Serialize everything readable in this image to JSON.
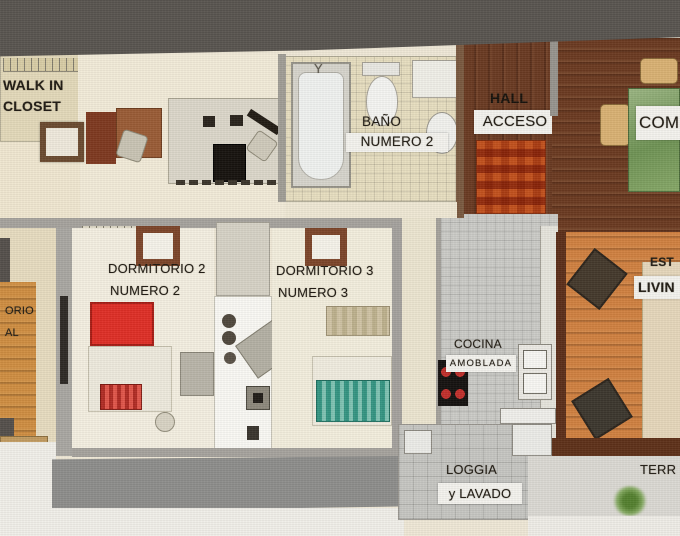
{
  "palette": {
    "photo_background": "#595550",
    "paper": "#f1efe9",
    "floor_cream": "#f2ebd8",
    "bath_tile": "#e7dec0",
    "wood_dark": "#6a3a22",
    "wood_orange": "#d08140",
    "kitchen_tile": "#cbcbc7",
    "wall_gray": "#a6a39d",
    "bed_red": "#df2f26",
    "bed_teal": "#3f9e8b",
    "hall_rug_orange": "#c2511d",
    "label_text": "#211c14",
    "label_strip_bg": "#f4f3ee"
  },
  "rooms": {
    "walk_in_closet": {
      "l1": "WALK IN",
      "l2": "CLOSET"
    },
    "bathroom_2": {
      "l1": "BAÑO",
      "l2": "NUMERO 2"
    },
    "hall": {
      "l1": "HALL",
      "l2": "ACCESO"
    },
    "dining": {
      "partial": "COME"
    },
    "bedroom_2": {
      "l1": "DORMITORIO 2",
      "l2": "NUMERO 2"
    },
    "bedroom_3": {
      "l1": "DORMITORIO 3",
      "l2": "NUMERO 3"
    },
    "master_bedroom": {
      "frag1": "ORIO",
      "frag2": "AL"
    },
    "kitchen": {
      "l1": "COCINA",
      "l2": "AMOBLADA"
    },
    "living": {
      "frag1": "EST",
      "frag2": "LIVIN"
    },
    "loggia": {
      "l1": "LOGGIA",
      "l2": "y LAVADO"
    },
    "terrace": {
      "partial": "TERR"
    }
  }
}
